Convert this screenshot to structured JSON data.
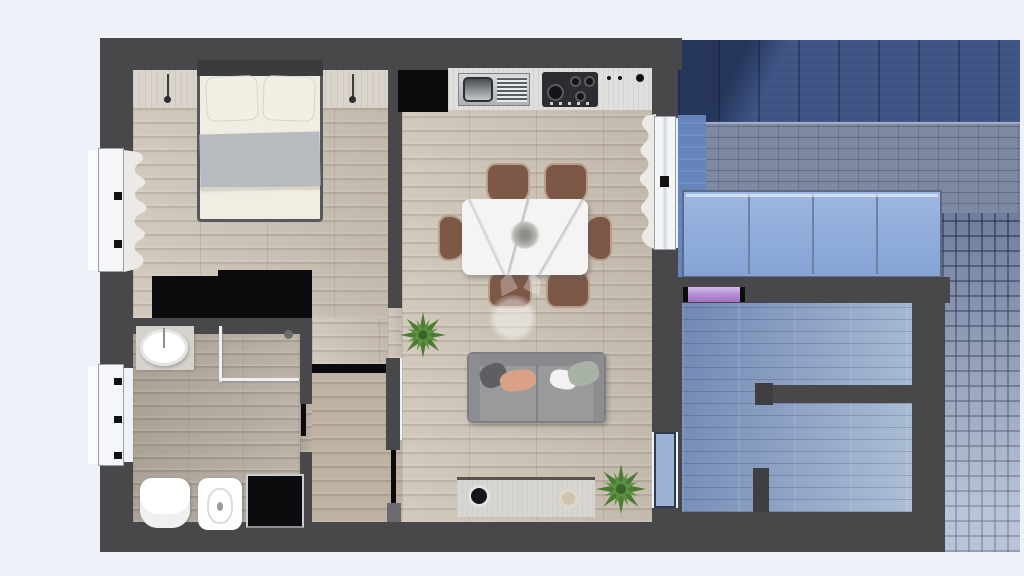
{
  "scene": {
    "type": "3d-floorplan-render",
    "description": "Top-down 3D render of a furnished one-bedroom apartment; exterior courtyard and neighbouring room at right are tinted blue",
    "background_color": "#edf2f8",
    "wall_color": "#48484a",
    "has_text": false
  },
  "rooms": [
    {
      "label": "Bedroom",
      "floor": "light oak planks",
      "furniture": [
        "double bed with white duvet and grey runner",
        "two white pillows",
        "headboard shelf with two pendant reading lamps",
        "black wardrobe",
        "window with curtain"
      ]
    },
    {
      "label": "Bathroom",
      "floor": "grey washed planks",
      "furniture": [
        "round basin on vanity",
        "corner shower with glass screen",
        "toilet",
        "bidet",
        "black washing machine",
        "window"
      ]
    },
    {
      "label": "Hallway",
      "floor": "oak planks",
      "furniture": [
        "open black door leaf"
      ]
    },
    {
      "label": "Living room with kitchen",
      "floor": "light oak planks",
      "furniture": [
        "black tall kitchen unit",
        "white counter with steel sink and gas hob",
        "white marble dining table",
        "six brown chairs",
        "grey sofa with four cushions",
        "media sideboard with speaker and vase",
        "two green potted plants",
        "glass door with curtain to terrace"
      ]
    },
    {
      "label": "Courtyard terrace (blue tinted)",
      "floor": "tiles and cobblestone",
      "furniture": [
        "glass balustrade",
        "purple-lit doorway"
      ]
    },
    {
      "label": "Neighbouring room (blue tinted)",
      "floor": "blue tinted planks",
      "furniture": [
        "internal partition walls"
      ]
    }
  ],
  "palette": {
    "background": "#edf2f8",
    "walls": "#48484a",
    "wood_floor": "#cdc3b6",
    "bathroom_floor": "#b6aca0",
    "blue_tint_base": "#5f77a3",
    "blue_dark_band": "#3d5484",
    "glass_balustrade": "#8fabdb",
    "cobblestone": "#93a3c2",
    "purple_door": "#b48ad2",
    "sofa": "#9a999b",
    "pillow_salmon": "#dba187",
    "pillow_sage": "#a9b2a6",
    "chair_brown": "#7d5847",
    "plant_green": "#4c7b33",
    "marble_table": "#f5f4f2"
  },
  "watermark": {
    "present": true,
    "style": "faint translucent white circular logo at centre of living room"
  }
}
